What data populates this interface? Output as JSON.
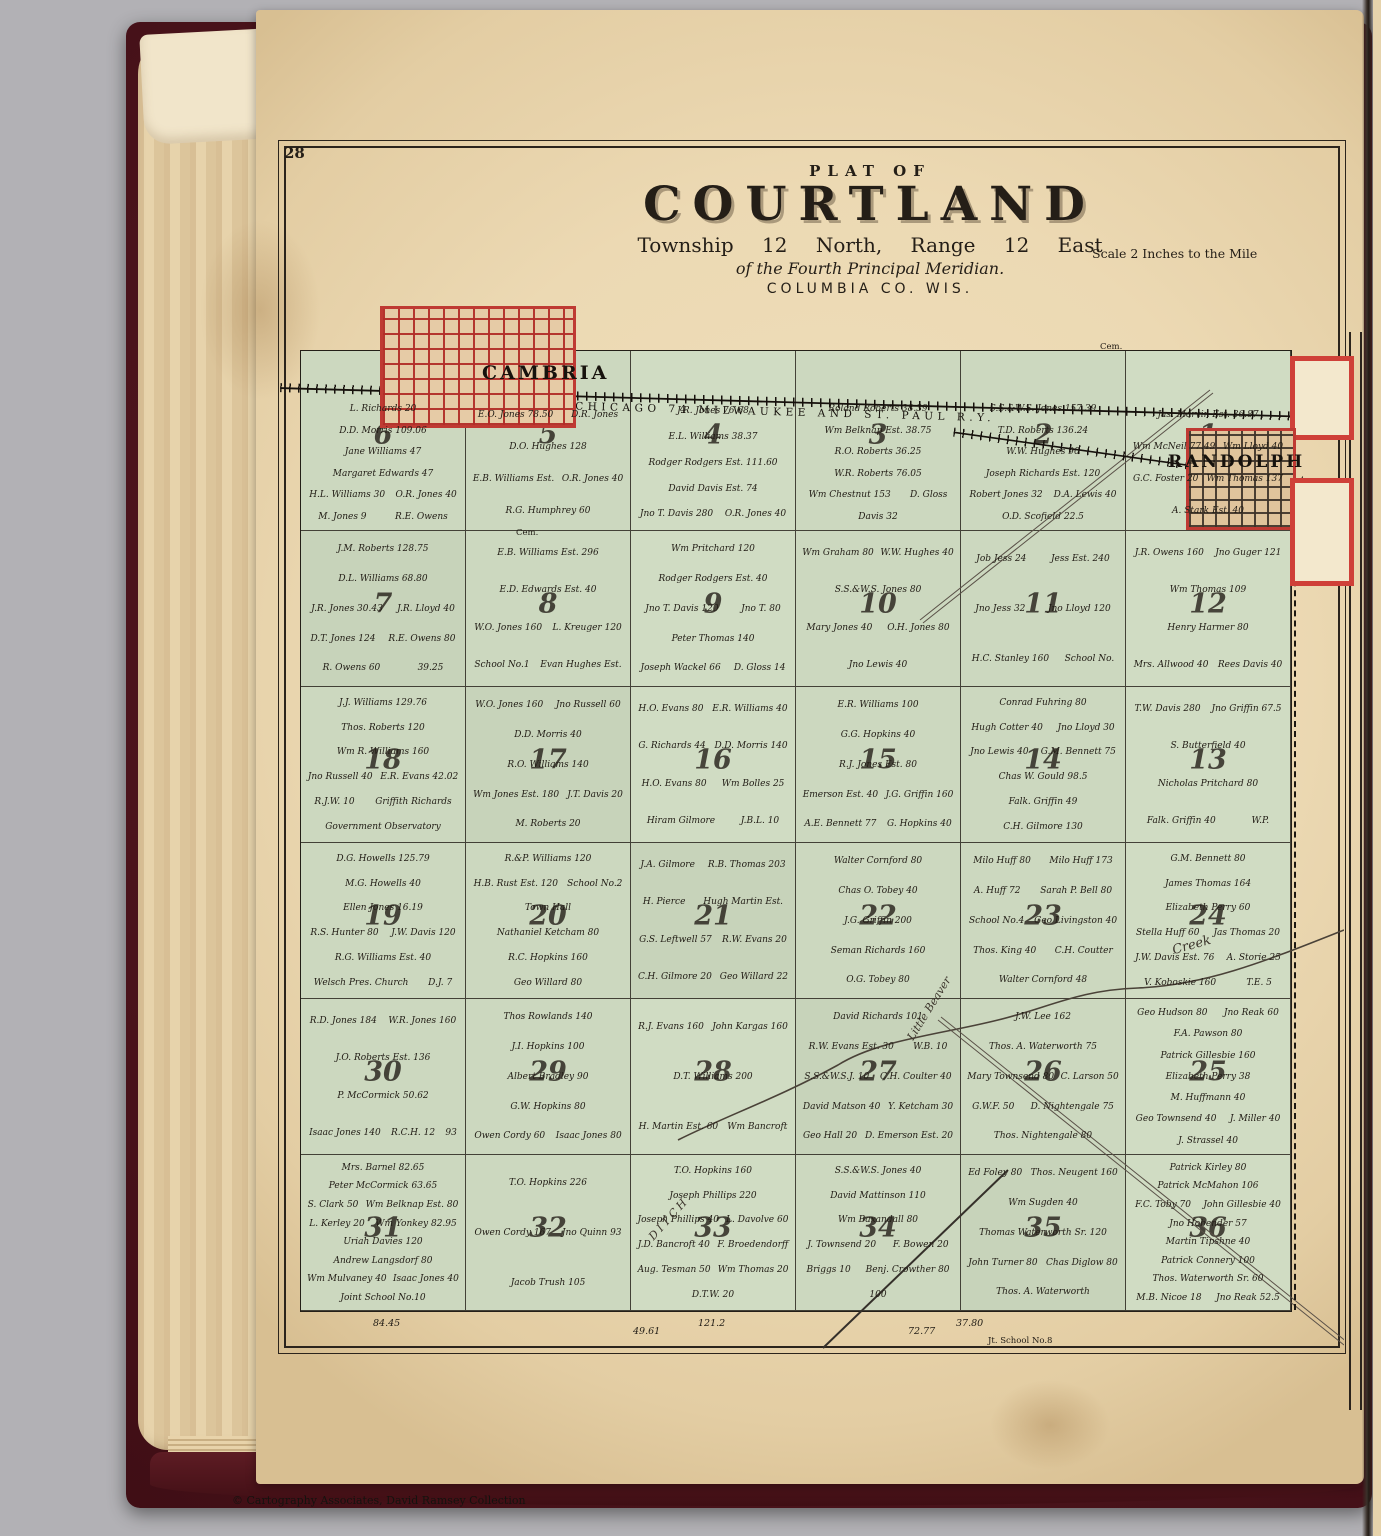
{
  "page": {
    "number": "28",
    "credit": "© Cartography Associates, David Ramsey Collection"
  },
  "title": {
    "plat_of": "PLAT OF",
    "name": "COURTLAND",
    "township_line": "Township 12 North, Range 12 East",
    "meridian_line": "of the Fourth Principal Meridian.",
    "county_line": "COLUMBIA CO. WIS.",
    "scale": "Scale 2 Inches to the Mile"
  },
  "railroad": {
    "label": "74 CHICAGO 74 MILWAUKEE AND ST. PAUL R.Y."
  },
  "towns": {
    "cambria": "CAMBRIA",
    "randolph": "RANDOLPH"
  },
  "water": {
    "creek": "Creek",
    "little_beaver": "Little Beaver",
    "ditch": "DITCH"
  },
  "small_labels": {
    "cem1": "Cem.",
    "cem2": "Cem.",
    "school8": "Jt. School No.8"
  },
  "edge_numbers": [
    "84.45",
    "49.61",
    "121.2",
    "72.77",
    "37.80"
  ],
  "sections": [
    {
      "num": "6",
      "owners": [
        "L. Richards 20",
        "D.D. Morris 109.06",
        "Jane Williams 47",
        "Margaret Edwards 47",
        "H.L. Williams 30",
        "O.R. Jones 40",
        "M. Jones 9",
        "R.E. Owens"
      ]
    },
    {
      "num": "5",
      "owners": [
        "E.O. Jones 78.50",
        "D.R. Jones",
        "D.O. Hughes 128",
        "E.B. Williams Est.",
        "O.R. Jones 40",
        "R.G. Humphrey 60"
      ]
    },
    {
      "num": "4",
      "owners": [
        "J.R. Jones 76.68",
        "E.L. Williams 38.37",
        "Rodger Rodgers Est. 111.60",
        "David Davis Est. 74",
        "Jno T. Davis 280",
        "O.R. Jones 40"
      ]
    },
    {
      "num": "3",
      "owners": [
        "Roland Roberts 38.39",
        "Wm Belknap Est. 38.75",
        "R.O. Roberts 36.25",
        "W.R. Roberts 76.05",
        "Wm Chestnut 153",
        "D. Gloss",
        "Davis 32"
      ]
    },
    {
      "num": "2",
      "owners": [
        "S.S.&W.S. Jones 157.39",
        "T.D. Roberts 136.24",
        "W.W. Hughes 90",
        "Joseph Richards Est. 120",
        "Robert Jones 32",
        "D.A. Lewis 40",
        "O.D. Scofield 22.5"
      ]
    },
    {
      "num": "1",
      "owners": [
        "Jas. Marvin Est. 36.87",
        "Wm McNeil 77.49",
        "Wm Lloyd 40",
        "G.C. Foster 20",
        "Wm Thomas 137",
        "A. Stark Est. 40"
      ]
    },
    {
      "num": "7",
      "owners": [
        "J.M. Roberts 128.75",
        "D.L. Williams 68.80",
        "J.R. Jones 30.43",
        "J.R. Lloyd 40",
        "D.T. Jones 124",
        "R.E. Owens 80",
        "R. Owens 60",
        "39.25"
      ]
    },
    {
      "num": "8",
      "owners": [
        "E.B. Williams Est. 296",
        "E.D. Edwards Est. 40",
        "W.O. Jones 160",
        "L. Kreuger 120",
        "School No.1",
        "Evan Hughes Est."
      ]
    },
    {
      "num": "9",
      "owners": [
        "Wm Pritchard 120",
        "Rodger Rodgers Est. 40",
        "Jno T. Davis 120",
        "Jno T. 80",
        "Peter Thomas 140",
        "Joseph Wackel 66",
        "D. Gloss 14"
      ]
    },
    {
      "num": "10",
      "owners": [
        "Wm Graham 80",
        "W.W. Hughes 40",
        "S.S.&W.S. Jones 80",
        "Mary Jones 40",
        "O.H. Jones 80",
        "Jno Lewis 40"
      ]
    },
    {
      "num": "11",
      "owners": [
        "Job Jess 24",
        "Jess Est. 240",
        "Jno Jess 32",
        "Jno Lloyd 120",
        "H.C. Stanley 160",
        "School No."
      ]
    },
    {
      "num": "12",
      "owners": [
        "J.R. Owens 160",
        "Jno Guger 121",
        "Wm Thomas 109",
        "Henry Harmer 80",
        "Mrs. Allwood 40",
        "Rees Davis 40"
      ]
    },
    {
      "num": "18",
      "owners": [
        "J.J. Williams 129.76",
        "Thos. Roberts 120",
        "Wm R. Williams 160",
        "Jno Russell 40",
        "E.R. Evans 42.02",
        "R.J.W. 10",
        "Griffith Richards",
        "Government Observatory"
      ]
    },
    {
      "num": "17",
      "owners": [
        "W.O. Jones 160",
        "Jno Russell 60",
        "D.D. Morris 40",
        "R.O. Williams 140",
        "Wm Jones Est. 180",
        "J.T. Davis 20",
        "M. Roberts 20"
      ]
    },
    {
      "num": "16",
      "owners": [
        "H.O. Evans 80",
        "E.R. Williams 40",
        "G. Richards 44",
        "D.D. Morris 140",
        "H.O. Evans 80",
        "Wm Bolles 25",
        "Hiram Gilmore",
        "J.B.L. 10"
      ]
    },
    {
      "num": "15",
      "owners": [
        "E.R. Williams 100",
        "G.G. Hopkins 40",
        "R.J. Jones Est. 80",
        "Emerson Est. 40",
        "J.G. Griffin 160",
        "A.E. Bennett 77",
        "G. Hopkins 40"
      ]
    },
    {
      "num": "14",
      "owners": [
        "Conrad Fuhring 80",
        "Hugh Cotter 40",
        "Jno Lloyd 30",
        "Jno Lewis 40",
        "G.M. Bennett 75",
        "Chas W. Gould 98.5",
        "Falk. Griffin 49",
        "C.H. Gilmore 130"
      ]
    },
    {
      "num": "13",
      "owners": [
        "T.W. Davis 280",
        "Jno Griffin 67.5",
        "S. Butterfield 40",
        "Nicholas Pritchard 80",
        "Falk. Griffin 40",
        "W.P."
      ]
    },
    {
      "num": "19",
      "owners": [
        "D.G. Howells 125.79",
        "M.G. Howells 40",
        "Ellen Jones 16.19",
        "R.S. Hunter 80",
        "J.W. Davis 120",
        "R.G. Williams Est. 40",
        "Welsch Pres. Church",
        "D.J. 7"
      ]
    },
    {
      "num": "20",
      "owners": [
        "R.&P. Williams 120",
        "H.B. Rust Est. 120",
        "School No.2",
        "Town Hall",
        "Nathaniel Ketcham 80",
        "R.C. Hopkins 160",
        "Geo Willard 80"
      ]
    },
    {
      "num": "21",
      "owners": [
        "J.A. Gilmore",
        "R.B. Thomas 203",
        "H. Pierce",
        "Hugh Martin Est.",
        "G.S. Leftwell 57",
        "R.W. Evans 20",
        "C.H. Gilmore 20",
        "Geo Willard 22"
      ]
    },
    {
      "num": "22",
      "owners": [
        "Walter Cornford 80",
        "Chas O. Tobey 40",
        "J.G. Griffin 200",
        "Seman Richards 160",
        "O.G. Tobey 80"
      ]
    },
    {
      "num": "23",
      "owners": [
        "Milo Huff 80",
        "Milo Huff 173",
        "A. Huff 72",
        "Sarah P. Bell 80",
        "School No.4",
        "Geo Livingston 40",
        "Thos. King 40",
        "C.H. Coutter",
        "Walter Cornford 48"
      ]
    },
    {
      "num": "24",
      "owners": [
        "G.M. Bennett 80",
        "James Thomas 164",
        "Elizabeth Perry 60",
        "Stella Huff 60",
        "Jas Thomas 20",
        "J.W. Davis Est. 76",
        "A. Storie 25",
        "V. Koboskie 160",
        "T.E. 5"
      ]
    },
    {
      "num": "30",
      "owners": [
        "R.D. Jones 184",
        "W.R. Jones 160",
        "J.O. Roberts Est. 136",
        "P. McCormick 50.62",
        "Isaac Jones 140",
        "R.C.H. 12",
        "93"
      ]
    },
    {
      "num": "29",
      "owners": [
        "Thos Rowlands 140",
        "J.I. Hopkins 100",
        "Albert Bradley 90",
        "G.W. Hopkins 80",
        "Owen Cordy 60",
        "Isaac Jones 80"
      ]
    },
    {
      "num": "28",
      "owners": [
        "R.J. Evans 160",
        "John Kargas 160",
        "D.T. Williams 200",
        "H. Martin Est. 60",
        "Wm Bancroft"
      ]
    },
    {
      "num": "27",
      "owners": [
        "David Richards 101",
        "R.W. Evans Est. 30",
        "W.B. 10",
        "S.S.&W.S.J. 10",
        "C.H. Coulter 40",
        "David Matson 40",
        "Y. Ketcham 30",
        "Geo Hall 20",
        "D. Emerson Est. 20"
      ]
    },
    {
      "num": "26",
      "owners": [
        "J.W. Lee 162",
        "Thos. A. Waterworth 75",
        "Mary Townsend 80",
        "C. Larson 50",
        "G.W.F. 50",
        "D. Nightengale 75",
        "Thos. Nightengale 80"
      ]
    },
    {
      "num": "25",
      "owners": [
        "Geo Hudson 80",
        "Jno Reak 60",
        "F.A. Pawson 80",
        "Patrick Gillesbie 160",
        "Elizabeth Perry 38",
        "M. Huffmann 40",
        "Geo Townsend 40",
        "J. Miller 40",
        "J. Strassel 40"
      ]
    },
    {
      "num": "31",
      "owners": [
        "Mrs. Barnel 82.65",
        "Peter McCormick 63.65",
        "S. Clark 50",
        "Wm Belknap Est. 80",
        "L. Kerley 20",
        "Wm Yonkey 82.95",
        "Uriah Davies 120",
        "Andrew Langsdorf 80",
        "Wm Mulvaney 40",
        "Isaac Jones 40",
        "Joint School No.10"
      ]
    },
    {
      "num": "32",
      "owners": [
        "T.O. Hopkins 226",
        "Owen Cordy 167",
        "Jno Quinn 93",
        "Jacob Trush 105"
      ]
    },
    {
      "num": "33",
      "owners": [
        "T.O. Hopkins 160",
        "Joseph Phillips 220",
        "Joseph Phillips 40",
        "L. Davolve 60",
        "J.D. Bancroft 40",
        "F. Broedendorff",
        "Aug. Tesman 50",
        "Wm Thomas 20",
        "D.T.W. 20"
      ]
    },
    {
      "num": "34",
      "owners": [
        "S.S.&W.S. Jones 40",
        "David Mattinson 110",
        "Wm Baxandall 80",
        "J. Townsend 20",
        "F. Bowen 20",
        "Briggs 10",
        "Benj. Crowther 80",
        "100"
      ]
    },
    {
      "num": "35",
      "owners": [
        "Ed Foley 80",
        "Thos. Neugent 160",
        "Wm Sugden 40",
        "Thomas Waterworth Sr. 120",
        "John Turner 80",
        "Chas Diglow 80",
        "Thos. A. Waterworth"
      ]
    },
    {
      "num": "36",
      "owners": [
        "Patrick Kirley 80",
        "Patrick McMahon 106",
        "F.C. Toby 70",
        "John Gillesbie 40",
        "Jno Hobender 57",
        "Martin Tipshne 40",
        "Patrick Connery 100",
        "Thos. Waterworth Sr. 60",
        "M.B. Nicoe 18",
        "Jno Reak 52.5"
      ]
    }
  ]
}
